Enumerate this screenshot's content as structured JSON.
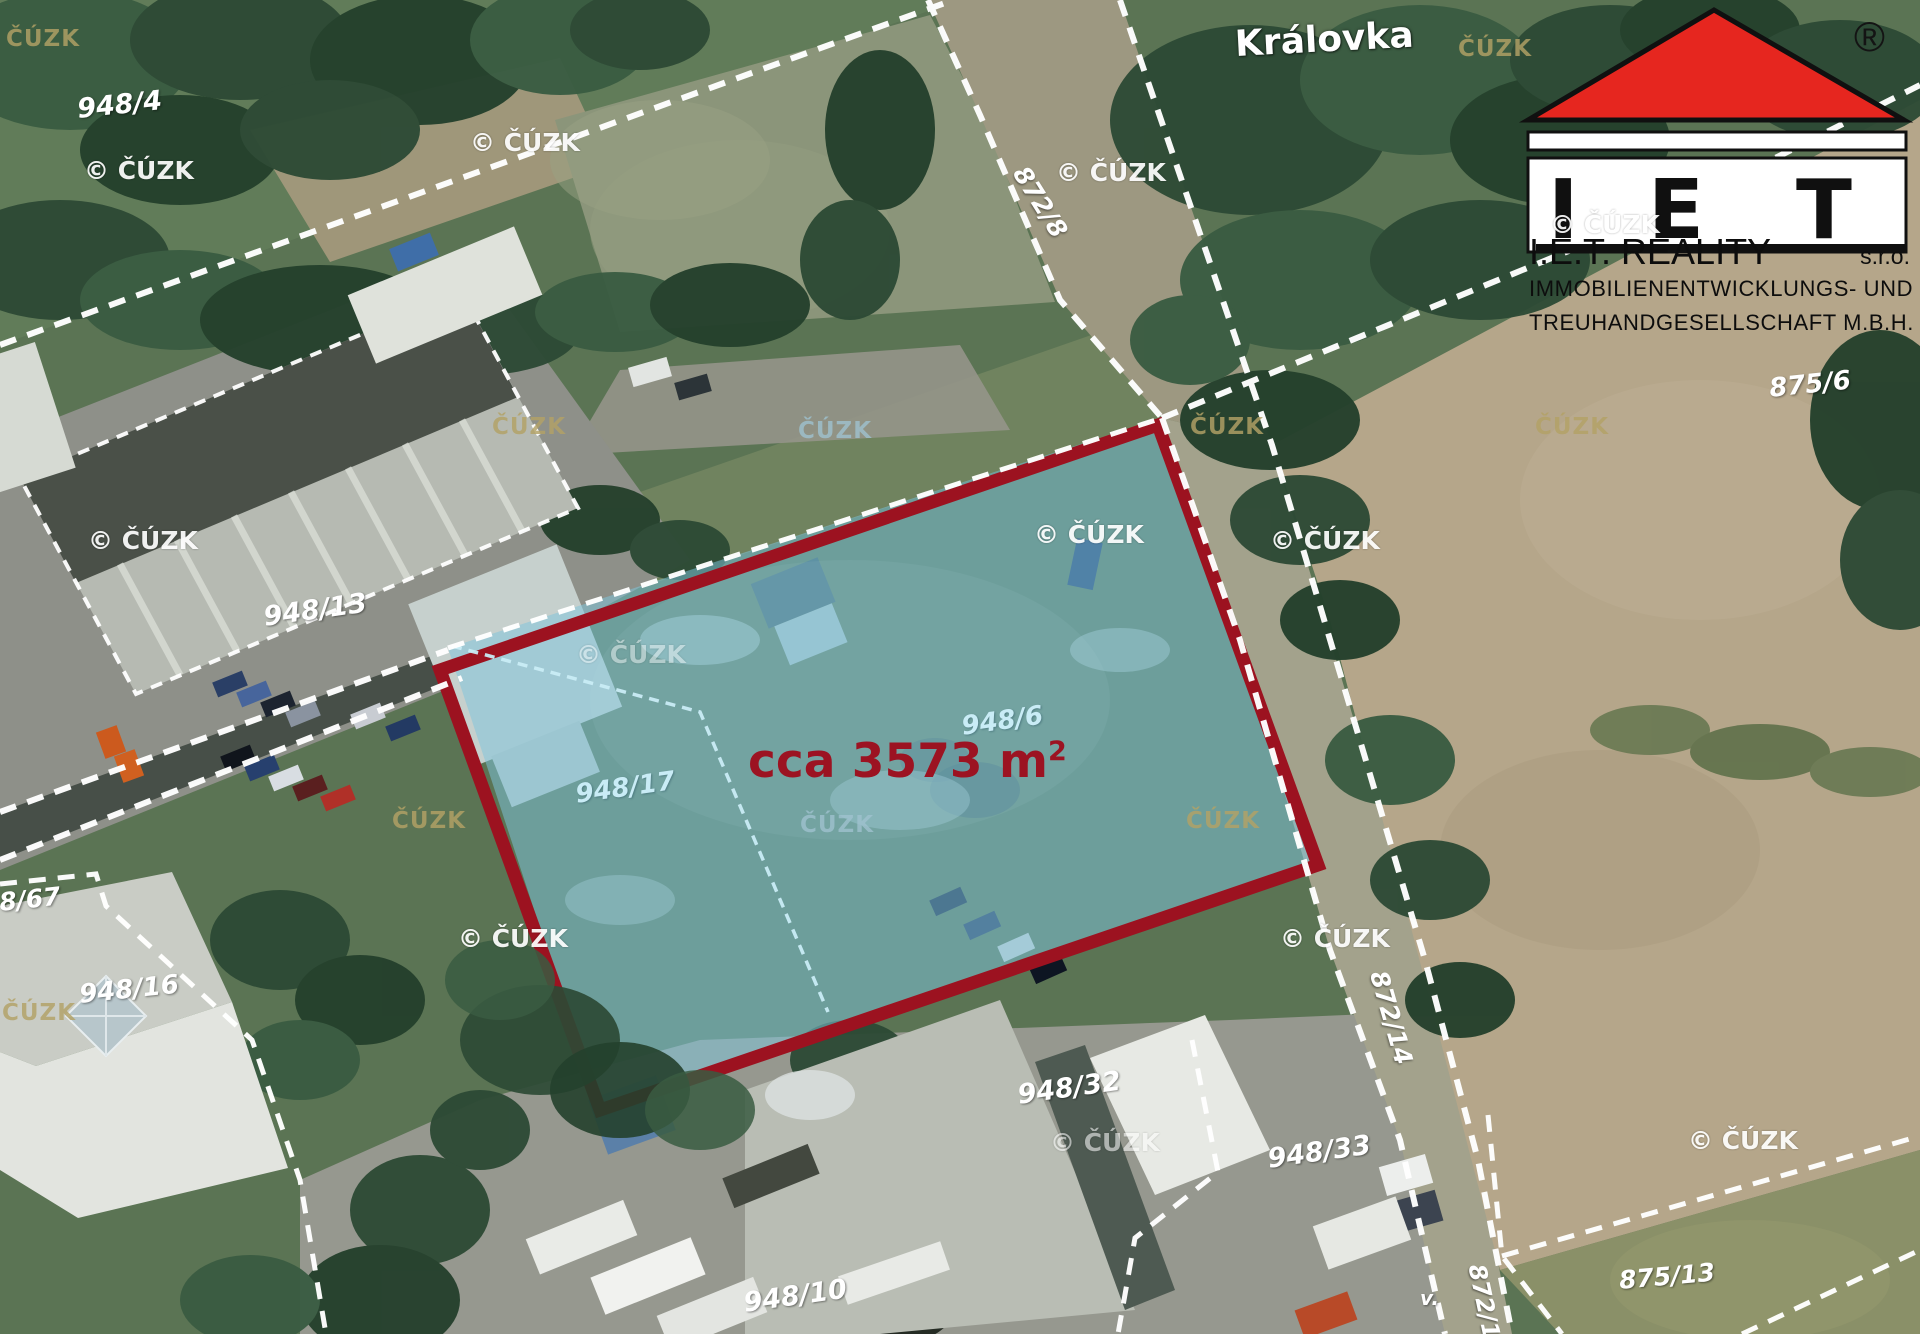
{
  "map": {
    "street_label": "Královka",
    "highlight": {
      "area_prefix": "cca 3573 m",
      "area_sup": "2"
    },
    "parcel_labels": [
      {
        "text": "948/4",
        "x": 76,
        "y": 96,
        "rot": -6,
        "style": "white",
        "size": 27
      },
      {
        "text": "948/13",
        "x": 262,
        "y": 604,
        "rot": -8,
        "style": "white",
        "size": 27
      },
      {
        "text": "875/6",
        "x": 1768,
        "y": 376,
        "rot": -6,
        "style": "white",
        "size": 26
      },
      {
        "text": "948/16",
        "x": 78,
        "y": 982,
        "rot": -6,
        "style": "white",
        "size": 26
      },
      {
        "text": "8/67",
        "x": -2,
        "y": 890,
        "rot": -6,
        "style": "white",
        "size": 25
      },
      {
        "text": "948/32",
        "x": 1016,
        "y": 1082,
        "rot": -8,
        "style": "white",
        "size": 27
      },
      {
        "text": "948/33",
        "x": 1266,
        "y": 1146,
        "rot": -8,
        "style": "white",
        "size": 27
      },
      {
        "text": "948/10",
        "x": 742,
        "y": 1290,
        "rot": -8,
        "style": "white",
        "size": 27
      },
      {
        "text": "875/13",
        "x": 1618,
        "y": 1268,
        "rot": -5,
        "style": "white",
        "size": 25
      },
      {
        "text": "872/8",
        "x": 1030,
        "y": 162,
        "rot": 58,
        "style": "white",
        "size": 25
      },
      {
        "text": "872/14",
        "x": 1390,
        "y": 968,
        "rot": 74,
        "style": "white",
        "size": 25
      },
      {
        "text": "872/10",
        "x": 1488,
        "y": 1262,
        "rot": 78,
        "style": "white",
        "size": 24
      },
      {
        "text": "v.",
        "x": 1420,
        "y": 1288,
        "rot": 0,
        "style": "white",
        "size": 20
      },
      {
        "text": "948/17",
        "x": 574,
        "y": 782,
        "rot": -8,
        "style": "lightblue",
        "size": 26
      },
      {
        "text": "948/6",
        "x": 960,
        "y": 714,
        "rot": -8,
        "style": "lightblue",
        "size": 26
      }
    ],
    "watermarks": {
      "cuzk_text": "ČÚZK",
      "copyright_text": "© ČÚZK",
      "tan": [
        {
          "x": 6,
          "y": 28
        },
        {
          "x": 1458,
          "y": 38
        },
        {
          "x": 492,
          "y": 416
        },
        {
          "x": 1190,
          "y": 416
        },
        {
          "x": 1535,
          "y": 416
        },
        {
          "x": 392,
          "y": 810
        },
        {
          "x": 1186,
          "y": 810
        },
        {
          "x": 2,
          "y": 1002
        },
        {
          "x": 798,
          "y": 420,
          "tint": true
        },
        {
          "x": 800,
          "y": 814,
          "tint": true
        }
      ],
      "copyright": [
        {
          "x": 84,
          "y": 158
        },
        {
          "x": 470,
          "y": 130
        },
        {
          "x": 1056,
          "y": 160
        },
        {
          "x": 88,
          "y": 528
        },
        {
          "x": 1034,
          "y": 522
        },
        {
          "x": 1270,
          "y": 528
        },
        {
          "x": 576,
          "y": 642,
          "op": 0.45
        },
        {
          "x": 458,
          "y": 926
        },
        {
          "x": 1280,
          "y": 926
        },
        {
          "x": 1688,
          "y": 1128
        },
        {
          "x": 1050,
          "y": 1130,
          "op": 0.55
        },
        {
          "x": 1550,
          "y": 212
        }
      ]
    }
  },
  "logo": {
    "registered": "®",
    "letters": [
      "I",
      "E",
      "T"
    ],
    "company": "I.E.T. REALITY",
    "legal_form": "s.r.o.",
    "line2": "IMMOBILIENENTWICKLUNGS- UND",
    "line3": "TREUHANDGESELLSCHAFT M.B.H.",
    "roof_color": "#e6261f"
  },
  "colors": {
    "highlight_fill": "#7ec6dc",
    "highlight_border": "#9c1220",
    "area_text": "#9c1322",
    "parcel_label_white": "#ffffff",
    "parcel_label_blue": "#c9ecf6",
    "watermark_tan": "#b3a266"
  }
}
